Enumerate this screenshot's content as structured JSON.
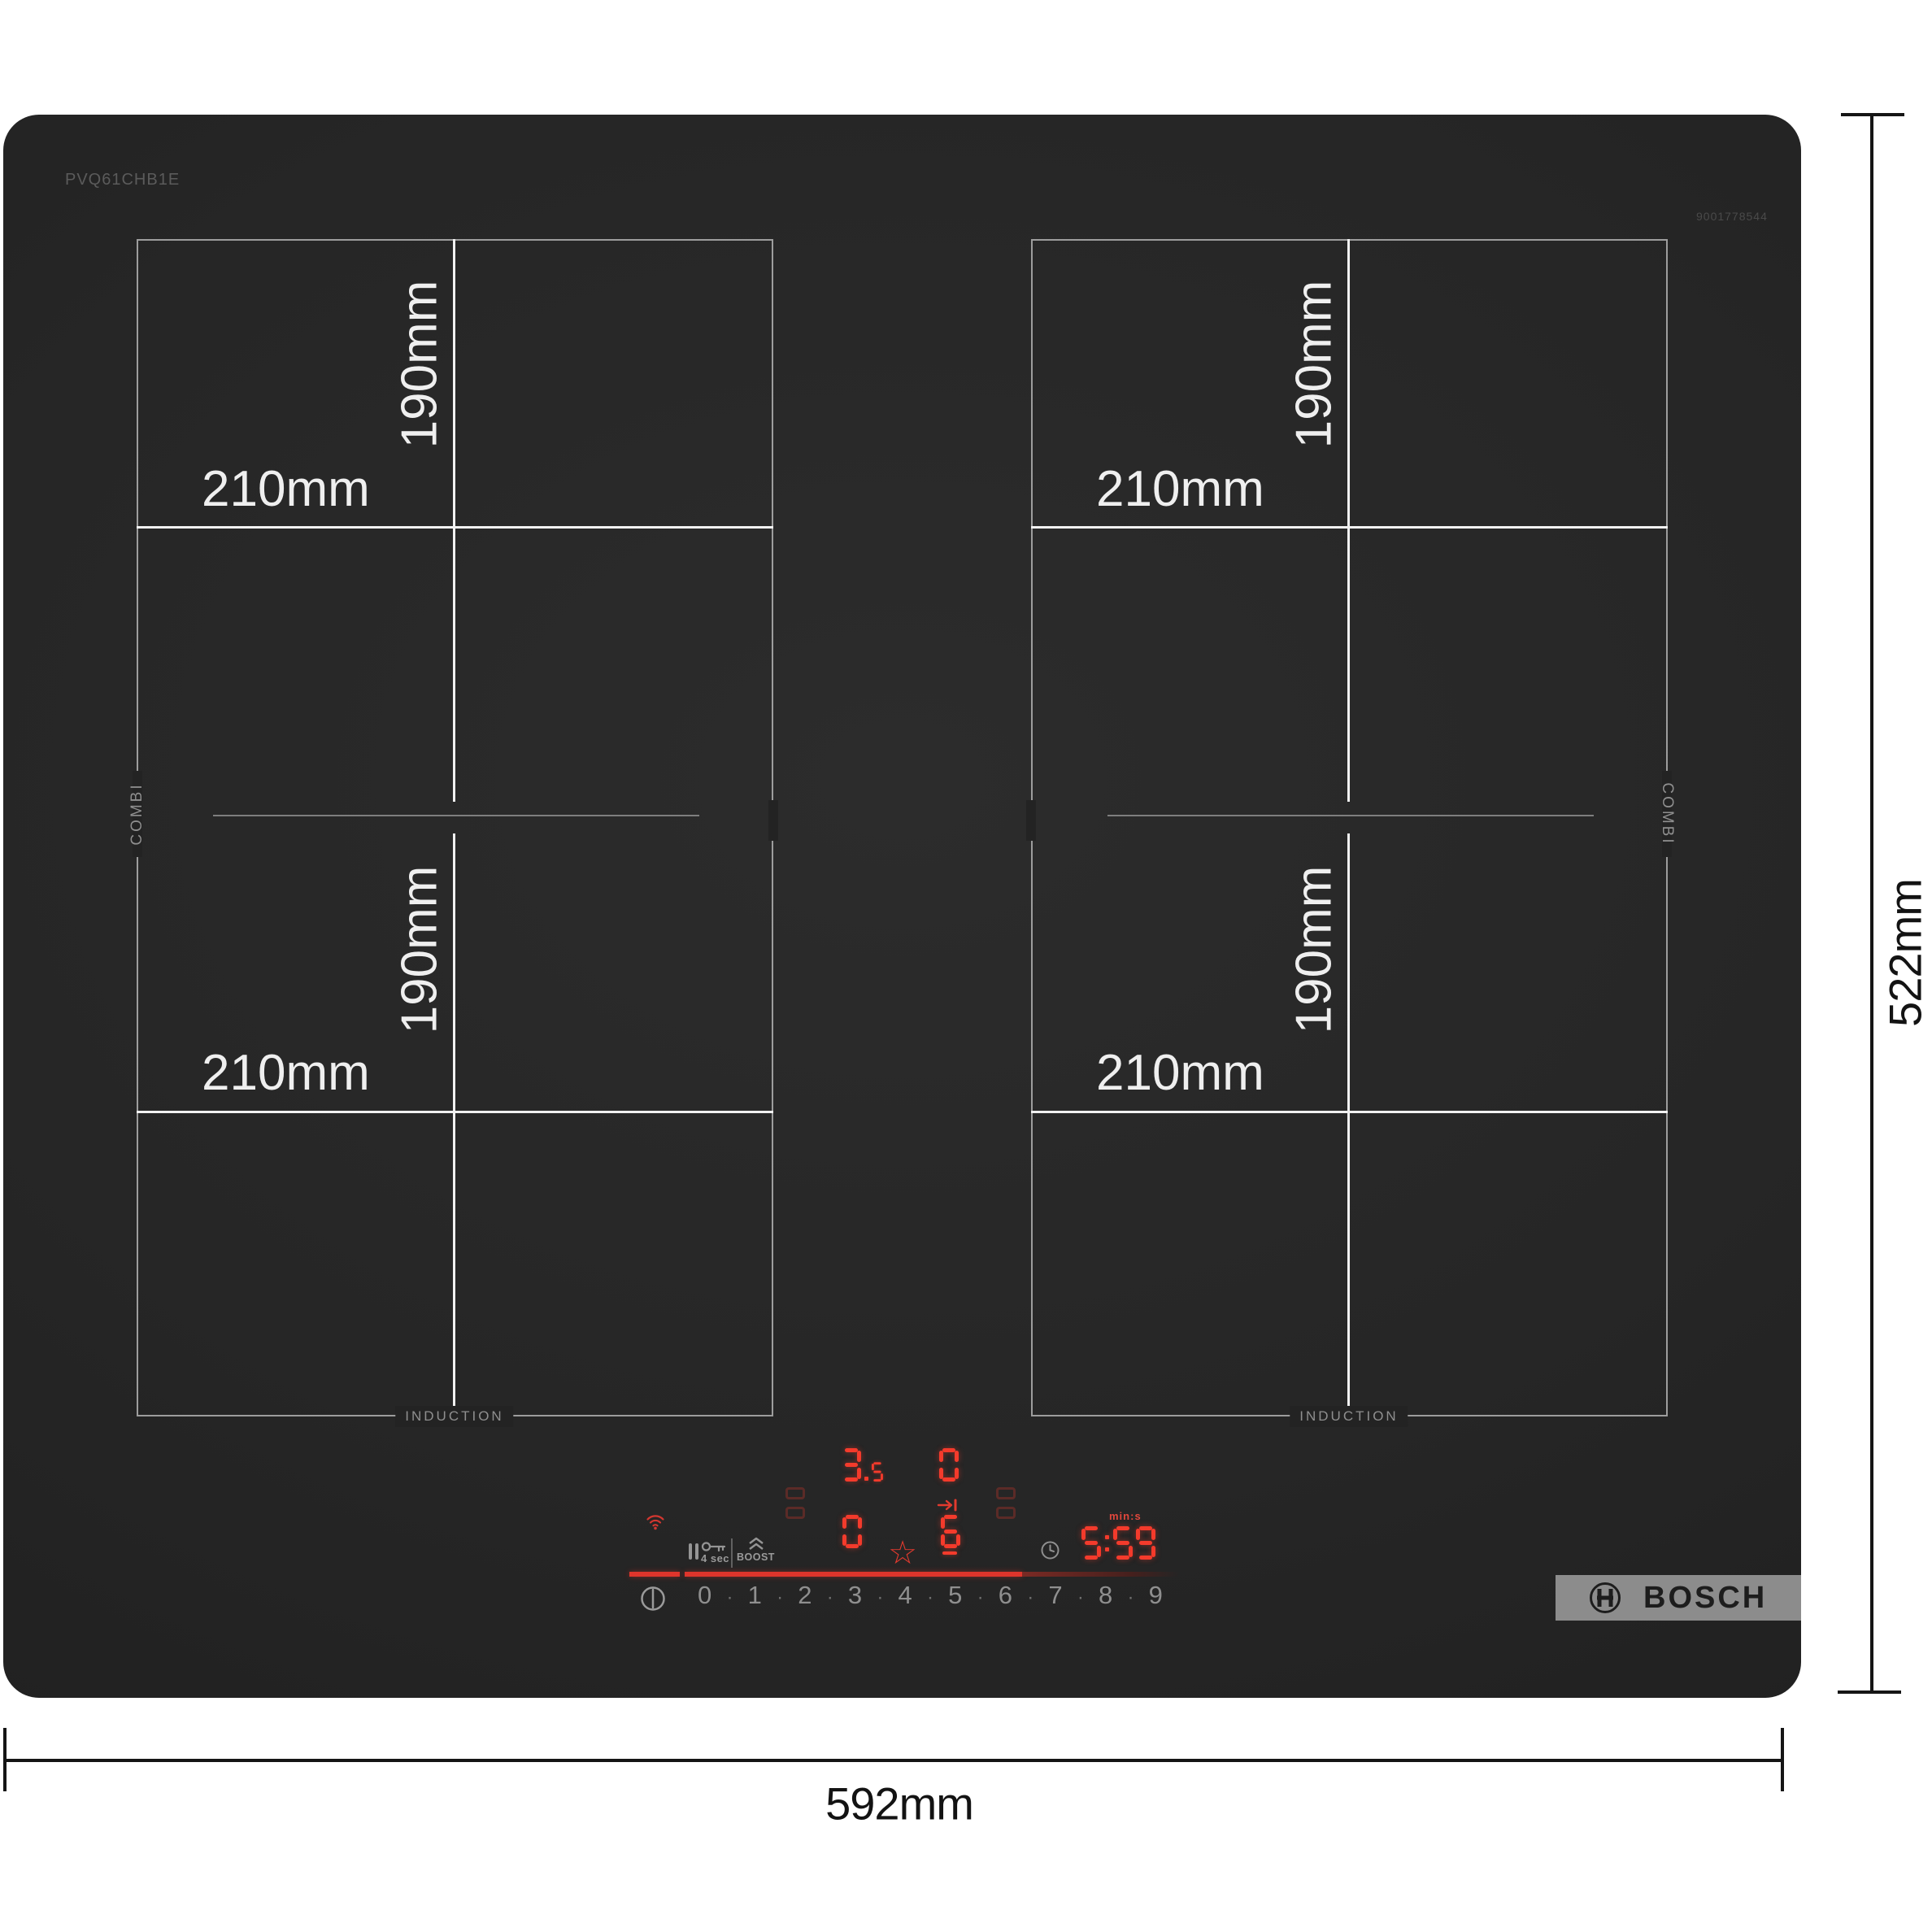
{
  "product": {
    "model": "PVQ61CHB1E",
    "serial_number": "9001778544",
    "brand": "BOSCH"
  },
  "overall_dimensions": {
    "width": "592mm",
    "height": "522mm"
  },
  "cooking_zones": {
    "zone_width": "210mm",
    "zone_height": "190mm",
    "combi_label": "COMBI",
    "induction_label": "INDUCTION"
  },
  "panel": {
    "displays": {
      "rear_left_power": "3.5",
      "rear_right_power": "0",
      "front_left_power": "0",
      "front_right_power": "6",
      "timer_value": "5:59",
      "timer_unit": "min:s"
    },
    "lock_hold_label": "4 sec",
    "boost_label": "BOOST",
    "levels": [
      "0",
      "1",
      "2",
      "3",
      "4",
      "5",
      "6",
      "7",
      "8",
      "9"
    ],
    "colors": {
      "led_red": "#f43b2c",
      "progress_red": "#df352c",
      "icon_gray": "#959595",
      "glass_black": "#242424",
      "logo_gray": "#8c8c8c"
    }
  },
  "icons": {
    "wifi": "wifi-arcs",
    "pause": "double-bar",
    "key_lock": "key-outline",
    "boost": "chevron-double-up",
    "favorite": "☆",
    "timer": "clock-outline",
    "power": "circle-with-bar",
    "move": "arrow-to-bar",
    "brand_symbol": "bosch-armature-in-circle"
  }
}
